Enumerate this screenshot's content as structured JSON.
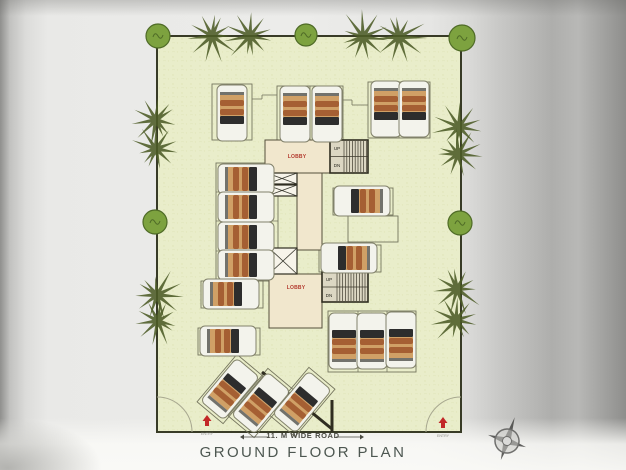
{
  "page": {
    "title": "GROUND FLOOR PLAN",
    "road_label": "11. M WIDE ROAD"
  },
  "labels": {
    "lobby": "LOBBY",
    "up": "UP",
    "dn": "DN",
    "entry": "ENTRY"
  },
  "colors": {
    "plot_fill": "#e9edca",
    "plot_stroke": "#383b26",
    "tree": "#4d5c27",
    "bush_fill": "#7da23f",
    "bush_stroke": "#4f6b27",
    "stall_stroke": "#75755e",
    "core_fill": "#f1e7cd",
    "core_stroke": "#55503c",
    "stair_fill": "#dcd7c3",
    "stair_tread": "#3c382c",
    "wall_dark": "#2f2d20",
    "car_body": "#f3f3ec",
    "car_stroke": "#82826b",
    "car_cabin": "#d0a066",
    "car_seat": "#a55f33",
    "car_glass": "#2d2d2d",
    "lobby_text": "#b33a2e",
    "entry_red": "#c22727",
    "caption_gray": "#90908a",
    "road_color": "#4b4b43",
    "compass_dark": "#454543"
  },
  "plan": {
    "plot": {
      "x": 157,
      "y": 36,
      "w": 304,
      "h": 396
    },
    "arcs": [
      {
        "d": "M 157 397 A 35 35 0 0 1 192 432"
      },
      {
        "d": "M 426 432 A 35 35 0 0 1 461 397"
      }
    ],
    "stalls": [
      {
        "x": 212,
        "y": 84,
        "w": 40,
        "h": 56,
        "dir": "v",
        "divs": []
      },
      {
        "x": 277,
        "y": 86,
        "w": 66,
        "h": 56,
        "dir": "v",
        "divs": [
          310
        ]
      },
      {
        "x": 368,
        "y": 82,
        "w": 62,
        "h": 56,
        "dir": "v",
        "divs": [
          399
        ]
      },
      {
        "x": 216,
        "y": 163,
        "w": 62,
        "h": 118,
        "dir": "h",
        "divs": [
          192,
          221,
          251
        ]
      },
      {
        "x": 201,
        "y": 281,
        "w": 62,
        "h": 27,
        "dir": "h",
        "divs": []
      },
      {
        "x": 198,
        "y": 328,
        "w": 62,
        "h": 27,
        "dir": "h",
        "divs": []
      },
      {
        "x": 333,
        "y": 188,
        "w": 60,
        "h": 27,
        "dir": "h",
        "divs": []
      },
      {
        "x": 348,
        "y": 216,
        "w": 50,
        "h": 26,
        "dir": "h",
        "divs": []
      },
      {
        "x": 319,
        "y": 245,
        "w": 62,
        "h": 27,
        "dir": "h",
        "divs": []
      },
      {
        "x": 328,
        "y": 311,
        "w": 88,
        "h": 61,
        "dir": "v",
        "divs": [
          358,
          387
        ]
      }
    ],
    "connectors": [
      [
        252,
        99,
        262,
        99
      ],
      [
        262,
        99,
        262,
        95
      ],
      [
        262,
        95,
        277,
        95
      ],
      [
        343,
        100,
        352,
        100
      ],
      [
        352,
        100,
        352,
        105
      ],
      [
        352,
        105,
        368,
        105
      ]
    ],
    "diag_stalls": [
      {
        "x": 230,
        "y": 389,
        "rot": 40
      },
      {
        "x": 261,
        "y": 403,
        "rot": 40
      },
      {
        "x": 302,
        "y": 402,
        "rot": 40
      }
    ],
    "core_rects": [
      {
        "x": 265,
        "y": 140,
        "w": 65,
        "h": 33
      },
      {
        "x": 297,
        "y": 173,
        "w": 25,
        "h": 77
      },
      {
        "x": 269,
        "y": 274,
        "w": 53,
        "h": 54
      }
    ],
    "stairs": [
      {
        "x": 330,
        "y": 140,
        "w": 38,
        "h": 33,
        "treadX": 344
      },
      {
        "x": 322,
        "y": 272,
        "w": 46,
        "h": 30,
        "treadX": 337
      }
    ],
    "lifts": [
      {
        "x": 267,
        "y": 173,
        "w": 30,
        "h": 11
      },
      {
        "x": 267,
        "y": 185,
        "w": 30,
        "h": 11
      },
      {
        "x": 269,
        "y": 248,
        "w": 28,
        "h": 26
      }
    ],
    "walls": [
      [
        262,
        372,
        332,
        429
      ],
      [
        332,
        400,
        332,
        432
      ]
    ],
    "cars": [
      {
        "x": 232,
        "y": 113,
        "rot": 180
      },
      {
        "x": 295,
        "y": 114,
        "rot": 180
      },
      {
        "x": 327,
        "y": 114,
        "rot": 180
      },
      {
        "x": 386,
        "y": 109,
        "rot": 180
      },
      {
        "x": 414,
        "y": 109,
        "rot": 180
      },
      {
        "x": 246,
        "y": 179,
        "rot": 90
      },
      {
        "x": 246,
        "y": 207,
        "rot": 90
      },
      {
        "x": 246,
        "y": 237,
        "rot": 90
      },
      {
        "x": 246,
        "y": 265,
        "rot": 90
      },
      {
        "x": 231,
        "y": 294,
        "rot": 90
      },
      {
        "x": 228,
        "y": 341,
        "rot": 90
      },
      {
        "x": 362,
        "y": 201,
        "rot": 270
      },
      {
        "x": 349,
        "y": 258,
        "rot": 270
      },
      {
        "x": 344,
        "y": 341,
        "rot": 0
      },
      {
        "x": 372,
        "y": 341,
        "rot": 0
      },
      {
        "x": 401,
        "y": 340,
        "rot": 0
      },
      {
        "x": 230,
        "y": 389,
        "rot": 40
      },
      {
        "x": 261,
        "y": 403,
        "rot": 40
      },
      {
        "x": 302,
        "y": 402,
        "rot": 40
      }
    ],
    "palms": [
      {
        "x": 212,
        "y": 36,
        "r": 27
      },
      {
        "x": 250,
        "y": 36,
        "r": 26
      },
      {
        "x": 363,
        "y": 37,
        "r": 27
      },
      {
        "x": 399,
        "y": 37,
        "r": 27
      },
      {
        "x": 156,
        "y": 120,
        "r": 25
      },
      {
        "x": 156,
        "y": 149,
        "r": 24
      },
      {
        "x": 157,
        "y": 295,
        "r": 26
      },
      {
        "x": 158,
        "y": 321,
        "r": 24
      },
      {
        "x": 459,
        "y": 127,
        "r": 26
      },
      {
        "x": 458,
        "y": 154,
        "r": 25
      },
      {
        "x": 457,
        "y": 289,
        "r": 26
      },
      {
        "x": 456,
        "y": 320,
        "r": 25
      }
    ],
    "bushes": [
      {
        "x": 158,
        "y": 36,
        "r": 12
      },
      {
        "x": 306,
        "y": 35,
        "r": 11
      },
      {
        "x": 462,
        "y": 38,
        "r": 13
      },
      {
        "x": 155,
        "y": 222,
        "r": 12
      },
      {
        "x": 460,
        "y": 223,
        "r": 12
      }
    ],
    "lobby_labels": [
      {
        "x": 297,
        "y": 158
      },
      {
        "x": 296,
        "y": 289
      }
    ],
    "updn": [
      {
        "x": 337,
        "y": 150,
        "t": "up"
      },
      {
        "x": 337,
        "y": 167,
        "t": "dn"
      },
      {
        "x": 329,
        "y": 281,
        "t": "up"
      },
      {
        "x": 329,
        "y": 297,
        "t": "dn"
      }
    ],
    "entries": [
      {
        "x": 207,
        "y": 421
      },
      {
        "x": 443,
        "y": 423
      }
    ],
    "road_arrows": [
      {
        "x1": 268,
        "x2": 244,
        "y": 437,
        "dir": "left"
      },
      {
        "x1": 336,
        "x2": 360,
        "y": 437,
        "dir": "right"
      }
    ],
    "compass": {
      "x": 507,
      "y": 441,
      "r": 22
    }
  }
}
